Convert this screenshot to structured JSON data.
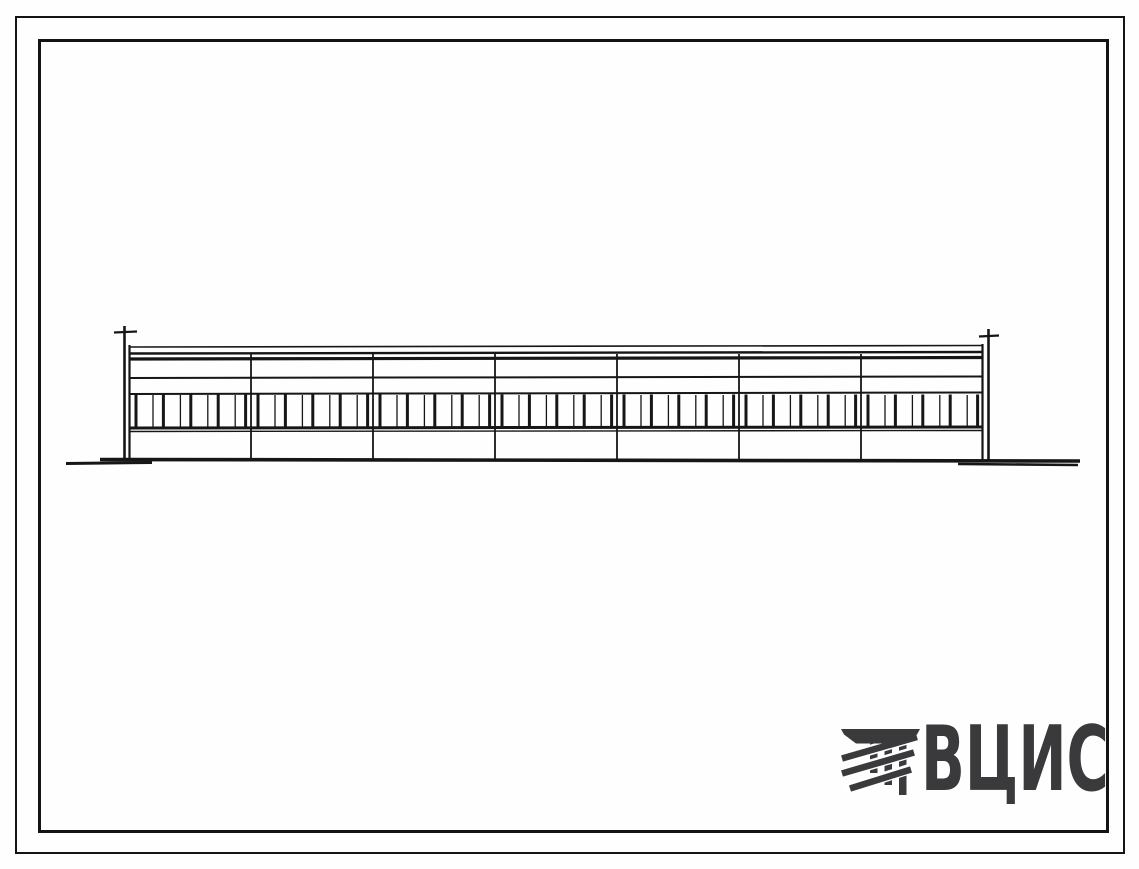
{
  "page": {
    "background_color": "#fefefe",
    "frame_color": "#141414"
  },
  "logo": {
    "text": "ВЦИС",
    "color": "#3a3a3c",
    "mark": "column-capital-with-diagonal-stripes-icon"
  },
  "drawing": {
    "subject": "single-story long building elevation, line drawing",
    "line_color": "#161616",
    "bays": 7,
    "window_units_per_bay": 4,
    "end_posts": 2
  }
}
